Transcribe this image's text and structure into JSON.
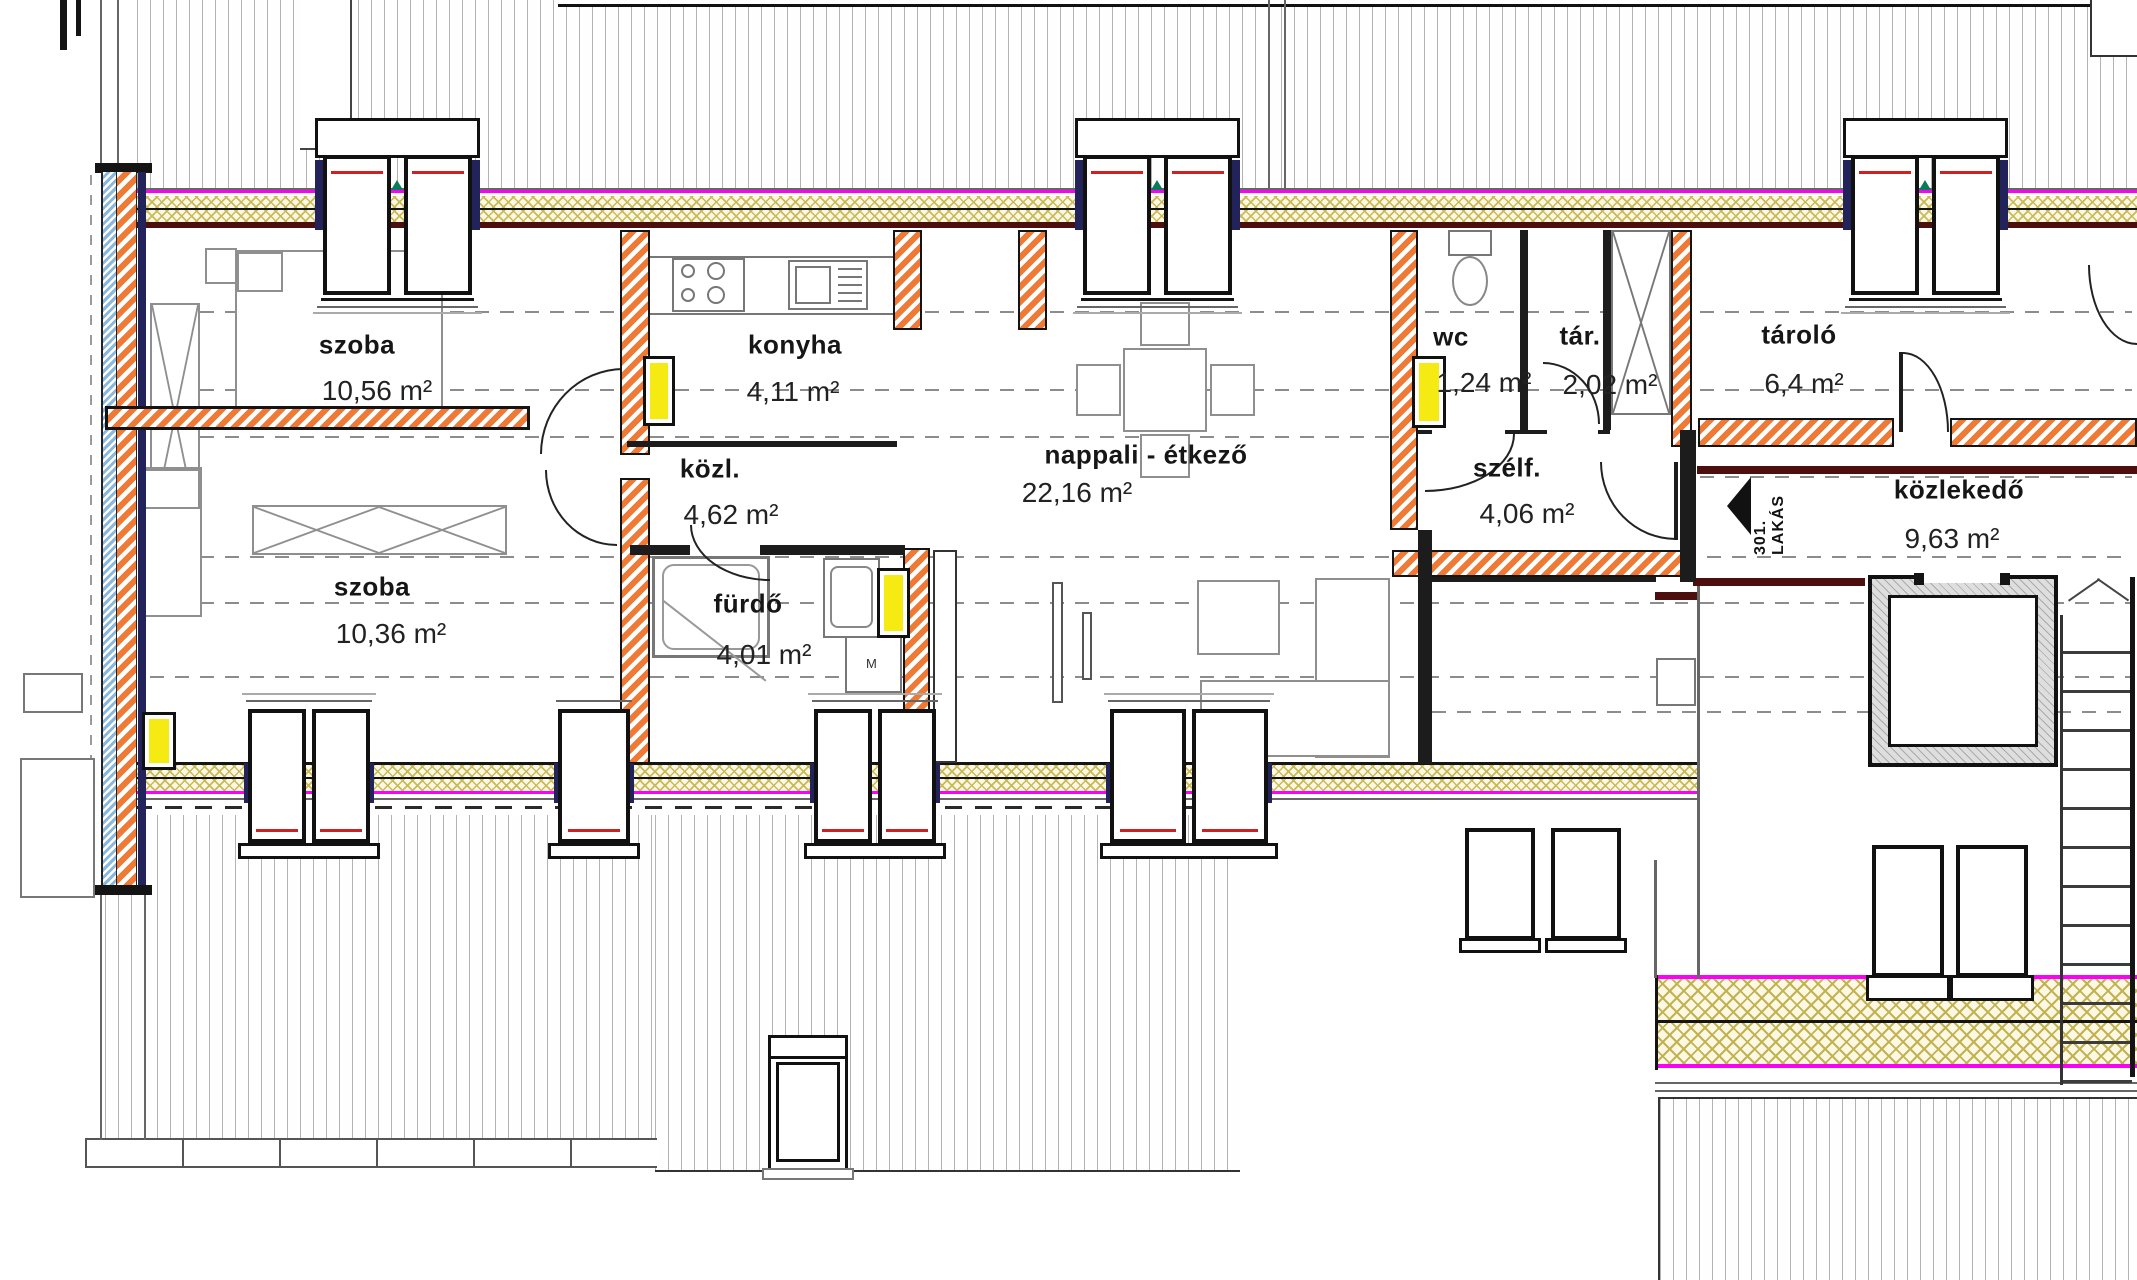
{
  "drawing": {
    "type": "apartment-floor-plan",
    "apartment_reference": "301. LAKÁS"
  },
  "rooms": [
    {
      "id": "szoba-1",
      "name": "szoba",
      "area": "10,56 m²"
    },
    {
      "id": "konyha",
      "name": "konyha",
      "area": "4,11 m²"
    },
    {
      "id": "kozl",
      "name": "közl.",
      "area": "4,62 m²"
    },
    {
      "id": "szoba-2",
      "name": "szoba",
      "area": "10,36 m²"
    },
    {
      "id": "furdo",
      "name": "fürdő",
      "area": "4,01 m²"
    },
    {
      "id": "nappali",
      "name": "nappali - étkező",
      "area": "22,16 m²"
    },
    {
      "id": "wc",
      "name": "wc",
      "area": "1,24 m²"
    },
    {
      "id": "tar",
      "name": "tár.",
      "area": "2,02 m²"
    },
    {
      "id": "szelf",
      "name": "szélf.",
      "area": "4,06 m²"
    },
    {
      "id": "tarolo",
      "name": "tároló",
      "area": "6,4 m²"
    },
    {
      "id": "kozlekedo",
      "name": "közlekedő",
      "area": "9,63 m²"
    }
  ],
  "annotations": {
    "apartment_label": "301. LAKÁS",
    "washing_machine": "M"
  },
  "colors": {
    "wall_brick_orange": "#EE7A35",
    "insulation_yellow": "#C9B957",
    "layer_magenta": "#F803F8",
    "radiator_yellow": "#F5EA12",
    "window_frame_navy": "#23235C",
    "waterproof_blue": "#8AB9DF",
    "floor_edge_maroon": "#4C0F0E",
    "roof_hatch_gray": "#B3B3B3"
  }
}
